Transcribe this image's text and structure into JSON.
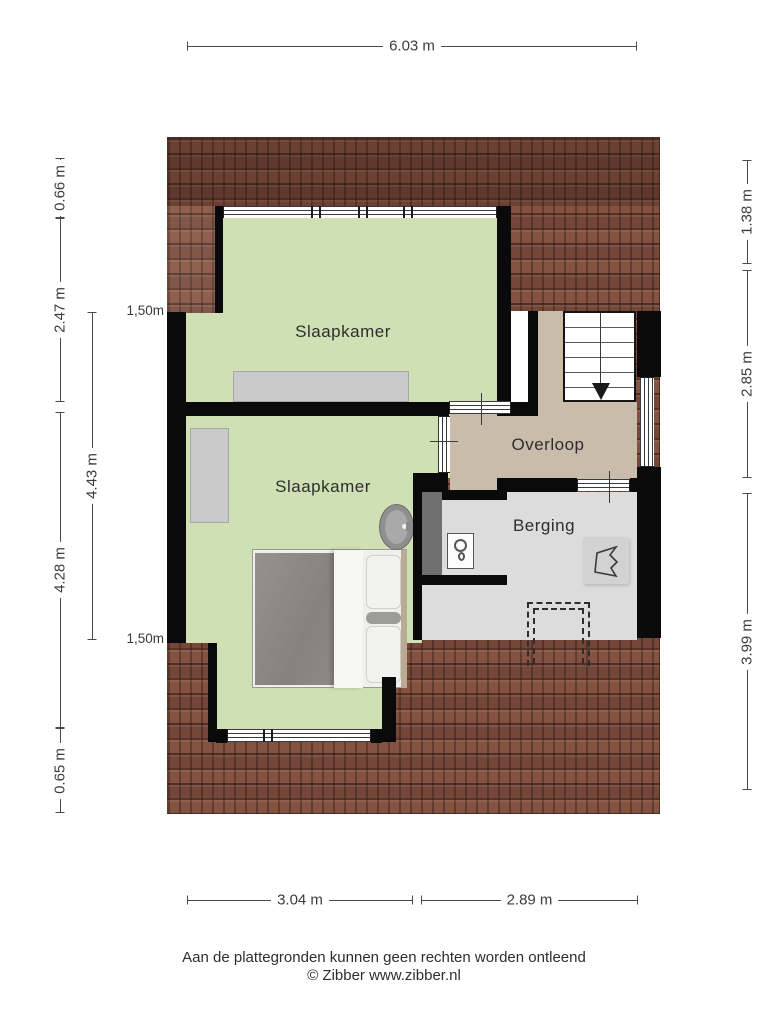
{
  "rooms": {
    "slaapkamer_top": {
      "label": "Slaapkamer"
    },
    "slaapkamer_bottom": {
      "label": "Slaapkamer"
    },
    "overloop": {
      "label": "Overloop"
    },
    "berging": {
      "label": "Berging"
    }
  },
  "dimensions": {
    "top_width": "6.03 m",
    "left_outer": [
      "0.66 m",
      "2.47 m",
      "4.28 m",
      "0.65 m"
    ],
    "left_inner": "4.43 m",
    "clearance_lines": [
      "1,50m",
      "1,50m"
    ],
    "right": [
      "1.38 m",
      "2.85 m",
      "3.99 m"
    ],
    "bottom": [
      "3.04 m",
      "2.89 m"
    ]
  },
  "footer": {
    "disclaimer": "Aan de plattegronden kunnen geen rechten worden ontleend",
    "credit": "© Zibber www.zibber.nl"
  },
  "colors": {
    "roof_tiles": "#8a5948",
    "bedroom_floor": "#cfe0b4",
    "landing_floor": "#c9bcaa",
    "storage_floor": "#dcdcdc",
    "wall": "#0a0a0a"
  },
  "fixtures": {
    "stairs_icon": "stairs-down-arrow",
    "bed_icon": "double-bed",
    "sink_icon": "wash-basin",
    "washer_icon": "washing-machine",
    "wardrobe_count": 2,
    "hatch_icon": "dashed-floor-hatch"
  }
}
